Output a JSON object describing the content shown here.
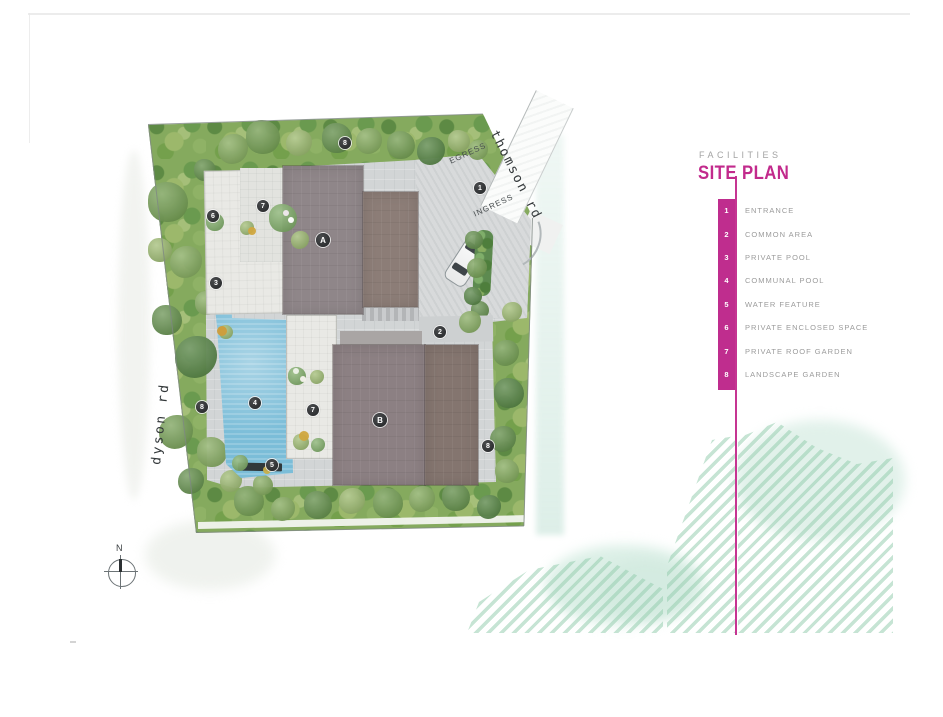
{
  "legend": {
    "eyebrow": "FACILITIES",
    "title": "SITE PLAN",
    "items": [
      {
        "num": "1",
        "label": "ENTRANCE"
      },
      {
        "num": "2",
        "label": "COMMON AREA"
      },
      {
        "num": "3",
        "label": "PRIVATE POOL"
      },
      {
        "num": "4",
        "label": "COMMUNAL POOL"
      },
      {
        "num": "5",
        "label": "WATER FEATURE"
      },
      {
        "num": "6",
        "label": "PRIVATE ENCLOSED SPACE"
      },
      {
        "num": "7",
        "label": "PRIVATE ROOF GARDEN"
      },
      {
        "num": "8",
        "label": "LANDSCAPE GARDEN"
      }
    ]
  },
  "plan": {
    "roads": {
      "thomson": "thomson rd",
      "dyson": "dyson rd"
    },
    "egress": "EGRESS",
    "ingress": "INGRESS",
    "buildings": [
      {
        "label": "A"
      },
      {
        "label": "B"
      }
    ],
    "markers": [
      {
        "id": "landscape-garden-top",
        "label": "8"
      },
      {
        "id": "private-enclosed-space",
        "label": "6"
      },
      {
        "id": "private-roof-garden-upper",
        "label": "7"
      },
      {
        "id": "private-pool",
        "label": "3"
      },
      {
        "id": "entrance",
        "label": "1"
      },
      {
        "id": "common-area",
        "label": "2"
      },
      {
        "id": "communal-pool",
        "label": "4"
      },
      {
        "id": "private-roof-garden-lower",
        "label": "7"
      },
      {
        "id": "water-feature",
        "label": "5"
      },
      {
        "id": "landscape-garden-left",
        "label": "8"
      },
      {
        "id": "landscape-garden-right",
        "label": "8"
      }
    ],
    "compass_n": "N"
  },
  "colors": {
    "accent": "#bf2d8e",
    "pool": "#7bbdd8",
    "roof_a": "#8f8689",
    "roof_b": "#84756f",
    "foliage": "#85aa5e",
    "mint_hatch": "#97ceb0"
  }
}
